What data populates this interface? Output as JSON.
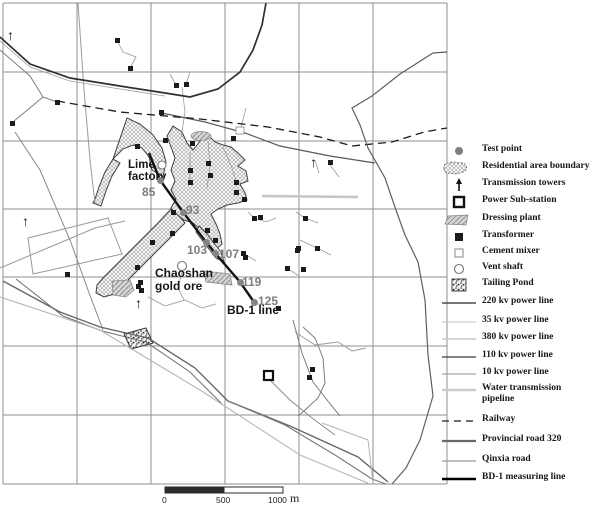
{
  "map": {
    "labels": {
      "lime_factory": "Lime factory",
      "chaoshan_gold_ore": "Chaoshan gold ore",
      "bd1_line": "BD-1 line"
    },
    "test_points": [
      {
        "num": "85",
        "dot": [
          160,
          180
        ],
        "label_pos": [
          142,
          186
        ]
      },
      {
        "num": "93",
        "dot": [
          183,
          212
        ],
        "label_pos": [
          186,
          204
        ]
      },
      {
        "num": "103",
        "dot": [
          206,
          242
        ],
        "label_pos": [
          187,
          244
        ]
      },
      {
        "num": "107",
        "dot": [
          215,
          253
        ],
        "label_pos": [
          219,
          248
        ]
      },
      {
        "num": "119",
        "dot": [
          240,
          282
        ],
        "label_pos": [
          242,
          276
        ]
      },
      {
        "num": "125",
        "dot": [
          254,
          302
        ],
        "label_pos": [
          258,
          295
        ]
      }
    ],
    "transformers": [
      [
        117,
        40
      ],
      [
        130,
        68
      ],
      [
        176,
        85
      ],
      [
        186,
        84
      ],
      [
        57,
        102
      ],
      [
        12,
        123
      ],
      [
        161,
        112
      ],
      [
        192,
        143
      ],
      [
        137,
        146
      ],
      [
        165,
        140
      ],
      [
        233,
        138
      ],
      [
        208,
        163
      ],
      [
        190,
        170
      ],
      [
        210,
        175
      ],
      [
        190,
        182
      ],
      [
        236,
        182
      ],
      [
        236,
        192
      ],
      [
        244,
        199
      ],
      [
        173,
        212
      ],
      [
        207,
        230
      ],
      [
        215,
        240
      ],
      [
        152,
        242
      ],
      [
        172,
        233
      ],
      [
        137,
        267
      ],
      [
        140,
        282
      ],
      [
        141,
        290
      ],
      [
        254,
        218
      ],
      [
        260,
        217
      ],
      [
        245,
        257
      ],
      [
        330,
        162
      ],
      [
        305,
        218
      ],
      [
        317,
        248
      ],
      [
        298,
        248
      ],
      [
        287,
        268
      ],
      [
        303,
        269
      ],
      [
        297,
        250
      ],
      [
        243,
        253
      ],
      [
        278,
        308
      ],
      [
        312,
        369
      ],
      [
        309,
        377
      ],
      [
        67,
        274
      ],
      [
        138,
        286
      ]
    ],
    "towers": [
      [
        12,
        30
      ],
      [
        27,
        216
      ],
      [
        315,
        157
      ],
      [
        140,
        298
      ]
    ]
  },
  "scale_bar": {
    "ticks": [
      "0",
      "500",
      "1000"
    ],
    "unit": "m"
  },
  "legend": {
    "items": [
      {
        "type": "test-point",
        "label": "Test point"
      },
      {
        "type": "residential-area-boundary",
        "label": "Residential area boundary"
      },
      {
        "type": "transmission-tower",
        "label": "Transmission towers"
      },
      {
        "type": "power-substation",
        "label": "Power Sub-station"
      },
      {
        "type": "dressing-plant",
        "label": "Dressing plant"
      },
      {
        "type": "transformer",
        "label": "Transformer"
      },
      {
        "type": "cement-mixer",
        "label": "Cement mixer"
      },
      {
        "type": "vent-shaft",
        "label": "Vent shaft"
      },
      {
        "type": "tailing-pond",
        "label": "Tailing Pond"
      },
      {
        "type": "line-220kv",
        "label": "220 kv power line"
      },
      {
        "type": "line-35kv",
        "label": "35 kv power line"
      },
      {
        "type": "line-380kv",
        "label": "380 kv power line"
      },
      {
        "type": "line-110kv",
        "label": "110 kv power line"
      },
      {
        "type": "line-10kv",
        "label": "10 kv power line"
      },
      {
        "type": "water-pipeline",
        "label": "Water transmission pipeline"
      },
      {
        "type": "railway",
        "label": "Railway"
      },
      {
        "type": "provincial-road",
        "label": "Provincial road 320"
      },
      {
        "type": "qinxia-road",
        "label": "Qinxia road"
      },
      {
        "type": "bd1-line",
        "label": "BD-1 measuring line"
      }
    ]
  },
  "colors": {
    "grid": "#8f8f8f",
    "test_point": "#858585",
    "test_label": "#7d7d7d",
    "road_dark": "#2f2f2f",
    "bd1": "#141414",
    "light_line": "#b5b5b5"
  }
}
